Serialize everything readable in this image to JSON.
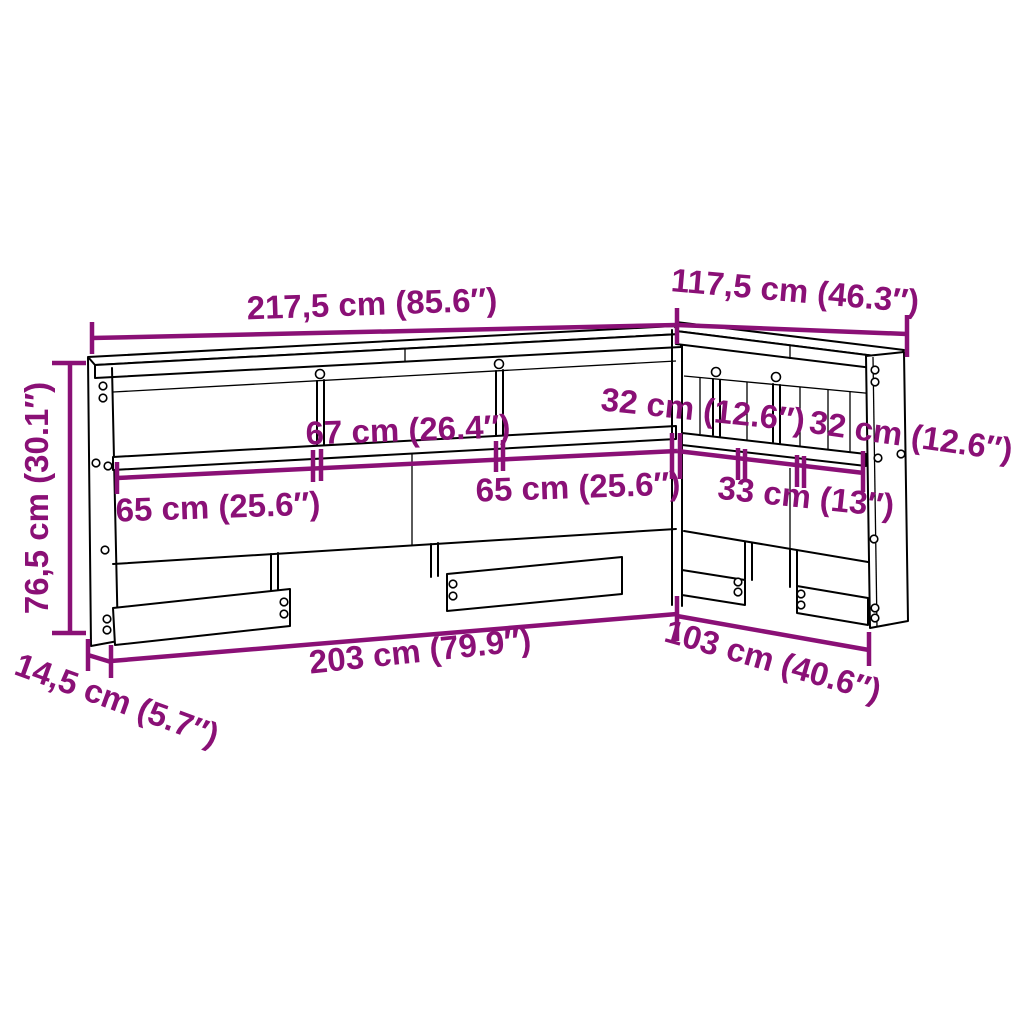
{
  "diagram": {
    "title": "L-shaped bookcase headboard dimension diagram",
    "colors": {
      "dimension": "#8A1076",
      "outline": "#000000",
      "background": "#FFFFFF"
    },
    "labels": {
      "top_width": "217,5 cm (85.6″)",
      "side_width": "117,5 cm (46.3″)",
      "height": "76,5 cm (30.1″)",
      "depth": "14,5 cm (5.7″)",
      "bottom_width": "203 cm (79.9″)",
      "bottom_side_width": "103 cm (40.6″)",
      "shelf_center": "67 cm (26.4″)",
      "shelf_left": "65 cm (25.6″)",
      "shelf_right": "65 cm (25.6″)",
      "side_segment_1": "32 cm (12.6″)",
      "side_segment_2": "32 cm (12.6″)",
      "side_segment_3": "33 cm (13″)"
    }
  }
}
